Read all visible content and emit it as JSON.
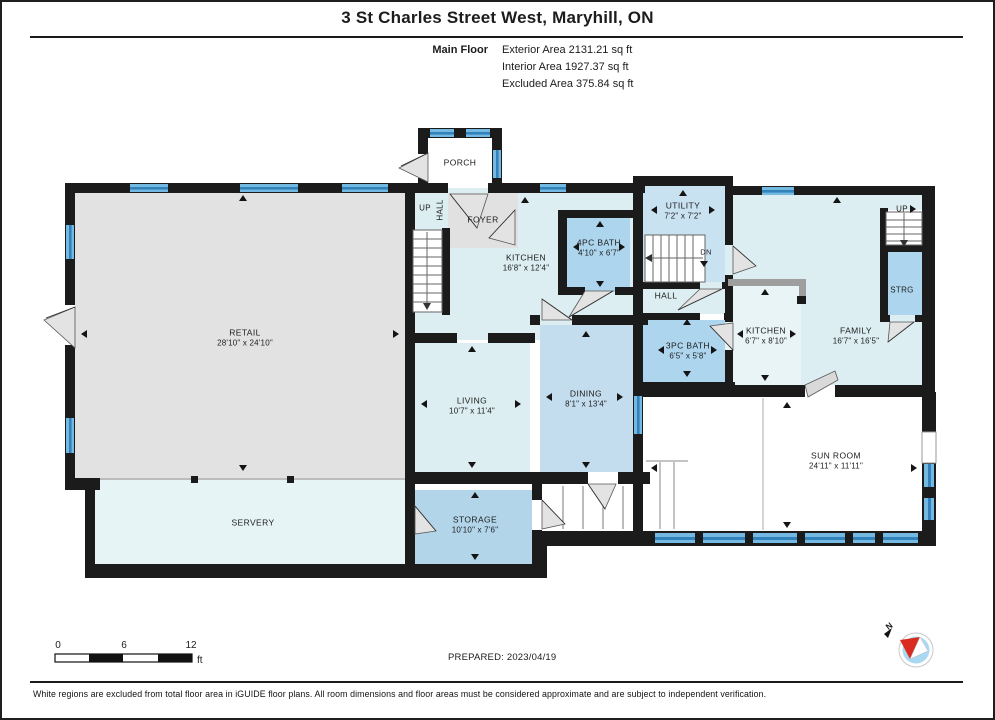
{
  "header": {
    "title": "3 St Charles Street West, Maryhill, ON",
    "floor_label": "Main Floor",
    "area_lines": [
      "Exterior Area 2131.21 sq ft",
      "Interior Area 1927.37 sq ft",
      "Excluded Area 375.84 sq ft"
    ]
  },
  "rooms": {
    "porch": {
      "name": "PORCH"
    },
    "foyer": {
      "name": "FOYER"
    },
    "stair_hall": {
      "up": "UP",
      "hall": "HALL"
    },
    "kitchen": {
      "name": "KITCHEN",
      "dims": "16'8\" x 12'4\""
    },
    "bath_4pc": {
      "name": "4PC BATH",
      "dims": "4'10\" x 6'7\""
    },
    "utility": {
      "name": "UTILITY",
      "dims": "7'2\" x 7'2\"",
      "dn": "DN"
    },
    "hall": {
      "name": "HALL"
    },
    "retail": {
      "name": "RETAIL",
      "dims": "28'10\" x 24'10\""
    },
    "living": {
      "name": "LIVING",
      "dims": "10'7\" x 11'4\""
    },
    "dining": {
      "name": "DINING",
      "dims": "8'1\" x 13'4\""
    },
    "bath_3pc": {
      "name": "3PC BATH",
      "dims": "6'5\" x 5'8\""
    },
    "kitchen2": {
      "name": "KITCHEN",
      "dims": "6'7\" x 8'10\""
    },
    "family": {
      "name": "FAMILY",
      "dims": "16'7\" x 16'5\""
    },
    "up_right": {
      "label": "UP"
    },
    "strg": {
      "name": "STRG"
    },
    "sun_room": {
      "name": "SUN ROOM",
      "dims": "24'11\" x 11'11\""
    },
    "servery": {
      "name": "SERVERY"
    },
    "storage": {
      "name": "STORAGE",
      "dims": "10'10\" x 7'6\""
    }
  },
  "scale_bar": {
    "tick0": "0",
    "tick1": "6",
    "tick2": "12",
    "unit": "ft"
  },
  "compass": {
    "north_label": "N"
  },
  "footer": {
    "prepared": "PREPARED: 2023/04/19",
    "disclaimer": "White regions are excluded from total floor area in iGUIDE floor plans. All room dimensions and floor areas must be considered approximate and are subject to independent verification."
  },
  "colors": {
    "wall": "#1b1b1b",
    "window_blue": "#74b9e2",
    "window_stripe": "#3382ba",
    "room_light_cyan": "#dceef2",
    "room_medium_blue": "#c3dcee",
    "room_bath_blue": "#aed5ee",
    "room_storage_blue": "#b2d5ea",
    "excluded_gray": "#e2e2e2",
    "excluded_white": "#ffffff",
    "compass_needle_red": "#d92b1f"
  }
}
